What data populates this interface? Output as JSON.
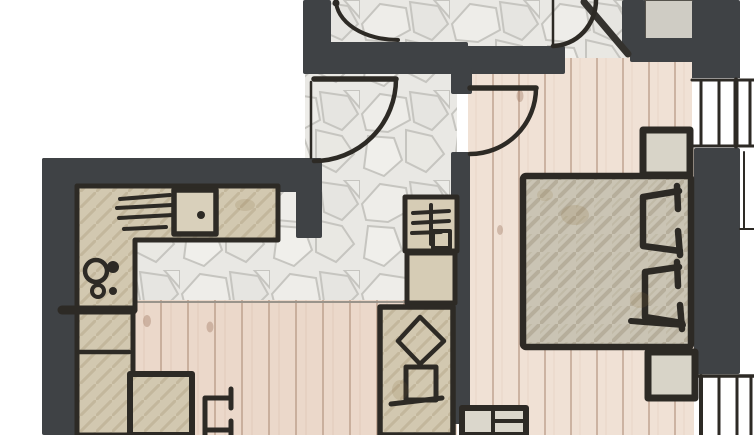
{
  "meta": {
    "title": "Hand-drawn apartment floor plan sketch",
    "type": "architectural-floor-plan",
    "visible_text": "none (drawing only, no labels or dimensions rendered)"
  },
  "palette": {
    "paper": "#ffffff",
    "wall": "#3f4245",
    "ink": "#2d2a25",
    "stone_base": "#e9e8e4",
    "stone_joint": "#c6c5c0",
    "wood_living": "#ebd8ca",
    "wood_living_line": "#c9af9d",
    "wood_bedroom": "#f0e1d5",
    "wood_bedroom_line": "#ccb3a2",
    "counter": "#d2c8b0",
    "bed": "#cac4b4",
    "niche": "#cfccc4",
    "furniture_light": "#d8d4c8"
  },
  "rooms": [
    {
      "id": "hallway",
      "label": "entry hallway with flagstone floor"
    },
    {
      "id": "kitchen-living",
      "label": "kitchen and living area with wood plank floor"
    },
    {
      "id": "bedroom",
      "label": "bedroom with wood plank floor"
    },
    {
      "id": "upper-room",
      "label": "adjoining room at top edge, partially visible, flagstone floor"
    }
  ],
  "furniture": {
    "kitchen": [
      {
        "id": "counter",
        "label": "L-shaped kitchen counter"
      },
      {
        "id": "dishrack",
        "label": "dish rack strokes on counter"
      },
      {
        "id": "sink",
        "label": "sink with drain dot"
      },
      {
        "id": "cooktop",
        "label": "cooktop with two burners and knobs"
      },
      {
        "id": "tall-unit",
        "label": "tall cabinet / fridge column along left wall"
      },
      {
        "id": "table",
        "label": "dining table"
      },
      {
        "id": "chair",
        "label": "chair beside table"
      }
    ],
    "hall": [
      {
        "id": "cabinet-top",
        "label": "cabinet with grille symbol"
      },
      {
        "id": "cabinet-middle",
        "label": "low cabinet"
      },
      {
        "id": "wardrobe",
        "label": "wardrobe with diamond motif and drawer"
      },
      {
        "id": "sideboard",
        "label": "sideboard with compartments at wall end"
      }
    ],
    "bedroom": [
      {
        "id": "bed",
        "label": "double bed with hatched duvet"
      },
      {
        "id": "pillow-upper",
        "label": "pillow, upper"
      },
      {
        "id": "pillow-lower",
        "label": "pillow, lower"
      },
      {
        "id": "nightstand-upper",
        "label": "nightstand, upper"
      },
      {
        "id": "nightstand-lower",
        "label": "nightstand, lower"
      }
    ]
  },
  "openings": {
    "doors": [
      {
        "id": "entrance-door",
        "swing": "quarter arc into hallway from left jamb"
      },
      {
        "id": "bedroom-door",
        "swing": "quarter arc into bedroom from top hinge"
      },
      {
        "id": "upper-room-door",
        "swing": "partial arc cut by top edge"
      },
      {
        "id": "top-right-door",
        "swing": "partial arc at top right, beside diagonal wall"
      }
    ],
    "windows": [
      {
        "id": "bedroom-window-right",
        "frame_bars": 4
      },
      {
        "id": "terrace-glazing-bottom-right",
        "frame_bars": 4
      }
    ]
  }
}
